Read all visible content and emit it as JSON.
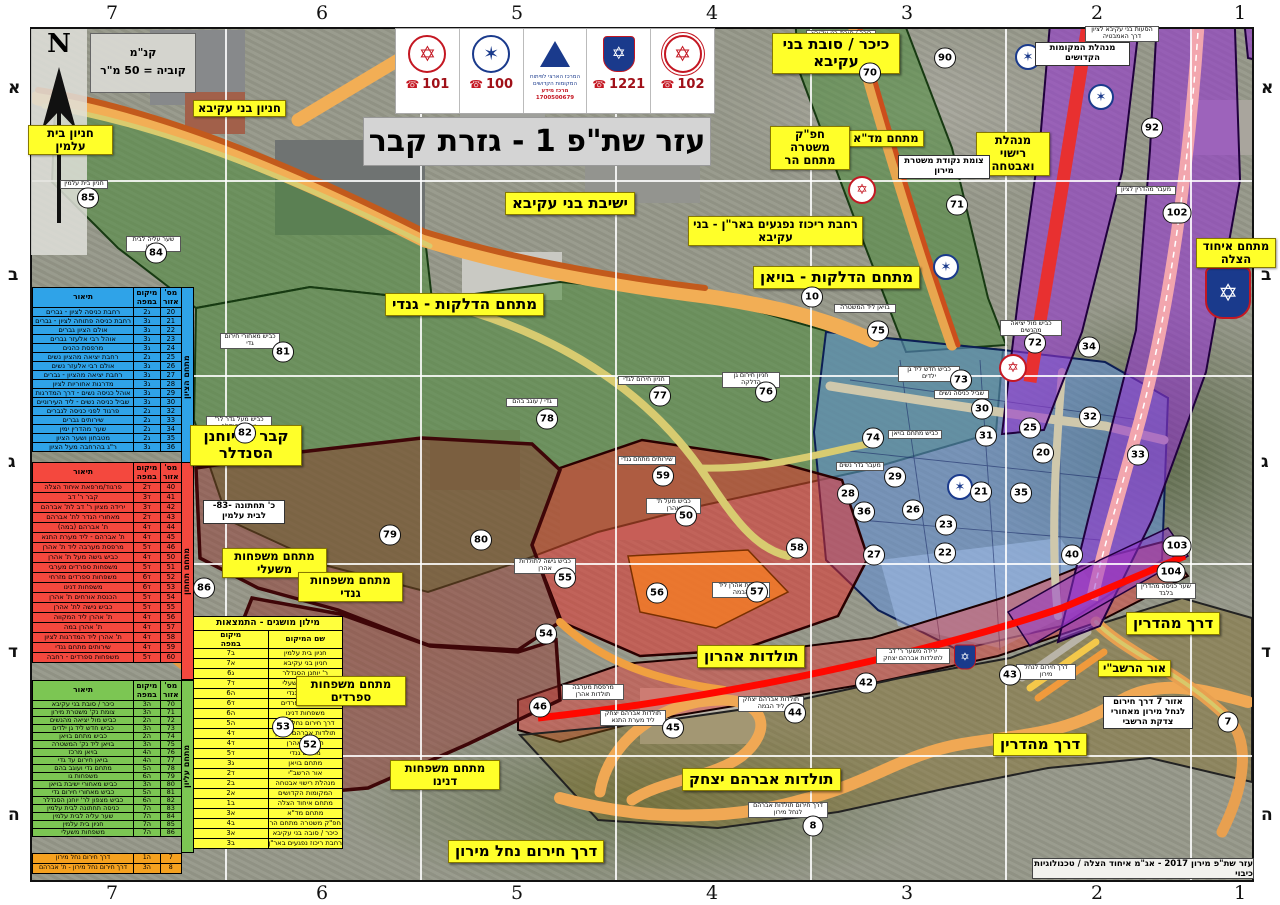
{
  "title": "עזר שת\"פ 1 - גזרת קבר",
  "attribution": "עזר שת\"פ מירון 2017 - אג\"מ איחוד הצלה / טכנולוגיות כיבוי",
  "north_label": "N",
  "scale": {
    "line1": "קנ\"מ",
    "line2": "קוביה = 50 מ\"ר"
  },
  "header": {
    "mda": {
      "phone": "101"
    },
    "police": {
      "phone": "100"
    },
    "center": {
      "line1": "המרכז הארצי לפיתוח",
      "line2": "המקומות הקדושים",
      "line3": "מרכז מידע",
      "line4": "1700500679"
    },
    "hatzalah": {
      "phone": "1221"
    },
    "fire": {
      "phone": "102"
    }
  },
  "grid": {
    "cols": [
      {
        "t": "7",
        "x": 112
      },
      {
        "t": "6",
        "x": 322
      },
      {
        "t": "5",
        "x": 517
      },
      {
        "t": "4",
        "x": 712
      },
      {
        "t": "3",
        "x": 907
      },
      {
        "t": "2",
        "x": 1097
      },
      {
        "t": "1",
        "x": 1240
      }
    ],
    "rows": [
      {
        "t": "א",
        "y": 88
      },
      {
        "t": "ב",
        "y": 275
      },
      {
        "t": "ג",
        "y": 462
      },
      {
        "t": "ד",
        "y": 652
      },
      {
        "t": "ה",
        "y": 815
      }
    ]
  },
  "legend": {
    "headers": {
      "n": "מס'\nאזור",
      "loc": "מיקום\nבמפה",
      "desc": "תיאור"
    },
    "blue": {
      "side": "מתחם הציון",
      "rows": [
        {
          "n": "20",
          "loc": "ג2",
          "d": "רחבת כניסה לציון - גברים"
        },
        {
          "n": "21",
          "loc": "ג3",
          "d": "רחבת כניסה פתוחה לציון - גברים"
        },
        {
          "n": "22",
          "loc": "ג3",
          "d": "אולם הציון גברים"
        },
        {
          "n": "23",
          "loc": "ג3",
          "d": "אוהל רבי אלעזר גברים"
        },
        {
          "n": "24",
          "loc": "ג3",
          "d": "מרפסת כהנים"
        },
        {
          "n": "25",
          "loc": "ג2",
          "d": "רחבת יציאה מהציון נשים"
        },
        {
          "n": "26",
          "loc": "ג3",
          "d": "אולם רבי אלעזר נשים"
        },
        {
          "n": "27",
          "loc": "ג3",
          "d": "רחבת יציאה מהציון - גברים"
        },
        {
          "n": "28",
          "loc": "ג3",
          "d": "מדרגות אחוריות לציון"
        },
        {
          "n": "29",
          "loc": "ג3",
          "d": "אוהל כניסה נשים - דרך המדרגות"
        },
        {
          "n": "30",
          "loc": "ג3",
          "d": "שביל כניסה נשים - ליד העירוניים"
        },
        {
          "n": "32",
          "loc": "ג2",
          "d": "פרגוד לפני כניסה לגברים"
        },
        {
          "n": "33",
          "loc": "ג2",
          "d": "שירותים גברים"
        },
        {
          "n": "34",
          "loc": "ג2",
          "d": "שער מהדרין ימין"
        },
        {
          "n": "35",
          "loc": "ג2",
          "d": "מטבחון ושער הציון"
        },
        {
          "n": "36",
          "loc": "ג3",
          "d": "ר\"ג בהרחבה מעל הציון"
        }
      ]
    },
    "red": {
      "side": "מתחם תחתון",
      "rows": [
        {
          "n": "40",
          "loc": "ד2",
          "d": "פרגוד/מרפאת איחוד הצלה"
        },
        {
          "n": "41",
          "loc": "ד3",
          "d": "קבר ר' דב"
        },
        {
          "n": "42",
          "loc": "ד3",
          "d": "ירידה מציון ר' דב לת' אברהם"
        },
        {
          "n": "43",
          "loc": "ד2",
          "d": "מאחורי הגדר לת' אברהם"
        },
        {
          "n": "44",
          "loc": "ד4",
          "d": "ת' אברהם (במה)"
        },
        {
          "n": "45",
          "loc": "ד4",
          "d": "ת' אברהם - ליד מערת התנא"
        },
        {
          "n": "46",
          "loc": "ד5",
          "d": "מרפסת מערבה ליד ת' אהרן"
        },
        {
          "n": "50",
          "loc": "ד4",
          "d": "כביש גישה מעל ת' אהרן"
        },
        {
          "n": "51",
          "loc": "ד5",
          "d": "משפחות ספרדים מערבי"
        },
        {
          "n": "52",
          "loc": "ד6",
          "d": "משפחות ספרדים מזרחי"
        },
        {
          "n": "53",
          "loc": "ד6",
          "d": "משפחות דנינו"
        },
        {
          "n": "54",
          "loc": "ד5",
          "d": "הכנסת אורחים ת' אהרן"
        },
        {
          "n": "55",
          "loc": "ד5",
          "d": "כביש גישה לת' אהרן"
        },
        {
          "n": "56",
          "loc": "ד4",
          "d": "ת' אהרן ליד המקווה"
        },
        {
          "n": "57",
          "loc": "ד4",
          "d": "ת' אהרן במה"
        },
        {
          "n": "58",
          "loc": "ד4",
          "d": "ת' אהרן ליד המדרגות לציון"
        },
        {
          "n": "59",
          "loc": "ד4",
          "d": "שירותים מתחם גנדי"
        },
        {
          "n": "60",
          "loc": "ד5",
          "d": "משפחות ספרדים - רחבה"
        }
      ]
    },
    "green": {
      "side": "מתחם עליון",
      "rows": [
        {
          "n": "70",
          "loc": "ה3",
          "d": "כיכר / סובת בני עקיבא"
        },
        {
          "n": "71",
          "loc": "ה3",
          "d": "צומת נק' משטרת מירון"
        },
        {
          "n": "72",
          "loc": "ה2",
          "d": "כביש מול יציאה מהנשים"
        },
        {
          "n": "73",
          "loc": "ה3",
          "d": "כביש חדש ליד גן ילדים"
        },
        {
          "n": "74",
          "loc": "ה2",
          "d": "כביש מתחם בויאן"
        },
        {
          "n": "75",
          "loc": "ה3",
          "d": "בויאן ליד נק' המשטרה"
        },
        {
          "n": "76",
          "loc": "ה4",
          "d": "בויאן מרכז"
        },
        {
          "n": "77",
          "loc": "ה4",
          "d": "בויאן חירום עד גדי"
        },
        {
          "n": "78",
          "loc": "ה5",
          "d": "מתחם גדי ועוגב בהם"
        },
        {
          "n": "79",
          "loc": "ה6",
          "d": "משפחות גו"
        },
        {
          "n": "80",
          "loc": "ה3",
          "d": "כביש מאחורי ישיבת בויאן"
        },
        {
          "n": "81",
          "loc": "ה5",
          "d": "כביש מאחורי חירום גדי"
        },
        {
          "n": "82",
          "loc": "ה6",
          "d": "כביש מצפון לר' יוחנן הסנדלר"
        },
        {
          "n": "83",
          "loc": "ה7",
          "d": "כניסה תחתונה לבית עלמין"
        },
        {
          "n": "84",
          "loc": "ה7",
          "d": "שער עליה לבית עלמין"
        },
        {
          "n": "85",
          "loc": "ה7",
          "d": "חניון בית עלמין"
        },
        {
          "n": "86",
          "loc": "ה7",
          "d": "משפחות משעלי"
        }
      ]
    },
    "orange": {
      "rows": [
        {
          "n": "7",
          "loc": "ה1",
          "d": "דרך חירום נחל מירון"
        },
        {
          "n": "8",
          "loc": "ה3",
          "d": "דרך חירום נחל מירון - ת' אברהם"
        }
      ]
    }
  },
  "glossary": {
    "title": "מילון מושגים - התמצאות",
    "headers": {
      "name": "שם המיקום",
      "loc": "מיקום\nבמפה"
    },
    "rows": [
      {
        "name": "חניון בית עלמין",
        "loc": "ב7"
      },
      {
        "name": "חניון בני עקיבא",
        "loc": "א7"
      },
      {
        "name": "ר' יוחנן הסנדלר",
        "loc": "ג6"
      },
      {
        "name": "משפחות משעלי",
        "loc": "ד7"
      },
      {
        "name": "משפחות גנדי",
        "loc": "ה6"
      },
      {
        "name": "משפחות ספרדים",
        "loc": "ד6"
      },
      {
        "name": "משפחות דנינו",
        "loc": "ה6"
      },
      {
        "name": "דרך חירום נחל מירון",
        "loc": "ה5"
      },
      {
        "name": "תולדות אברהם יצחק",
        "loc": "ד4"
      },
      {
        "name": "תולדות אהרן",
        "loc": "ד4"
      },
      {
        "name": "מתחם גנדי",
        "loc": "ד5"
      },
      {
        "name": "מתחם בויאן",
        "loc": "ג3"
      },
      {
        "name": "אור הרשב\"י",
        "loc": "ד2"
      },
      {
        "name": "מנהלת רישוי אבטחה",
        "loc": "ב2"
      },
      {
        "name": "המקומות הקדושים",
        "loc": "א2"
      },
      {
        "name": "מתחם איחוד הצלה",
        "loc": "ב1"
      },
      {
        "name": "מתחם מד\"א",
        "loc": "א3"
      },
      {
        "name": "חפ\"ק משטרה מתחם הר",
        "loc": "ב4"
      },
      {
        "name": "כיכר / סובה בני עקיבא",
        "loc": "א3"
      },
      {
        "name": "רחבת ריכוז נפגעים באר\"ן - בני עקיבא",
        "loc": "ב3"
      }
    ]
  },
  "callouts": [
    {
      "t": "ישיבת בני עקיבא",
      "x": 505,
      "y": 192,
      "cls": "ylg"
    },
    {
      "t": "מתחם הדלקות - בויאן",
      "x": 753,
      "y": 266,
      "cls": "ylg"
    },
    {
      "t": "מתחם הדלקות - גנדי",
      "x": 385,
      "y": 293,
      "cls": "ylg"
    },
    {
      "t": "תולדות אהרון",
      "x": 697,
      "y": 645,
      "cls": "ylg"
    },
    {
      "t": "תולדות אברהם יצחק",
      "x": 682,
      "y": 768,
      "cls": "ylg"
    },
    {
      "t": "דרך מהדרין",
      "x": 1126,
      "y": 612,
      "cls": "ylg"
    },
    {
      "t": "דרך מהדרין",
      "x": 993,
      "y": 733,
      "cls": "ylg"
    },
    {
      "t": "דרך חירום נחל מירון",
      "x": 448,
      "y": 840,
      "cls": "ylg"
    },
    {
      "t": "כיכר / סובת בני עקיבא",
      "x": 772,
      "y": 33,
      "cls": "ylg",
      "w": 128
    },
    {
      "t": "קבר ר' יוחנן הסנדלר",
      "x": 190,
      "y": 425,
      "cls": "ylg",
      "w": 112
    },
    {
      "t": "חניון בני עקיבא",
      "x": 193,
      "y": 100,
      "cls": "ymd"
    },
    {
      "t": "חניון בית עלמין",
      "x": 28,
      "y": 125,
      "cls": "ymd",
      "w": 85
    },
    {
      "t": "מתחם משפחות משעלי",
      "x": 222,
      "y": 548,
      "cls": "ymd",
      "w": 105
    },
    {
      "t": "מתחם משפחות גנדי",
      "x": 298,
      "y": 572,
      "cls": "ymd",
      "w": 105
    },
    {
      "t": "מתחם משפחות ספרדים",
      "x": 296,
      "y": 676,
      "cls": "ymd",
      "w": 110
    },
    {
      "t": "מתחם משפחות דנינו",
      "x": 390,
      "y": 760,
      "cls": "ymd",
      "w": 110
    },
    {
      "t": "מתחם איחוד הצלה",
      "x": 1196,
      "y": 238,
      "cls": "ymd",
      "w": 80
    },
    {
      "t": "אור הרשב\"י",
      "x": 1098,
      "y": 660,
      "cls": "ymd"
    },
    {
      "t": "מנהלת רישוי ואבטחה",
      "x": 976,
      "y": 132,
      "cls": "ymd",
      "w": 74
    },
    {
      "t": "מתחם מד\"א",
      "x": 848,
      "y": 130,
      "cls": "ymd"
    },
    {
      "t": "חפ\"ק משטרה מתחם הר",
      "x": 770,
      "y": 126,
      "cls": "ymd",
      "w": 80
    },
    {
      "t": "רחבת ריכוז נפגעים באר\"ן - בני עקיבא",
      "x": 688,
      "y": 216,
      "cls": "ymd",
      "w": 175
    },
    {
      "t": "צומת נקודת משטרת מירון",
      "x": 898,
      "y": 155,
      "cls": "wsm",
      "w": 92
    },
    {
      "t": "מנהלת המקומות הקדושים",
      "x": 1035,
      "y": 42,
      "cls": "wsm",
      "w": 95
    },
    {
      "t": "כ' תחתונה -83- לבית עלמין",
      "x": 203,
      "y": 500,
      "cls": "wsm",
      "w": 82
    },
    {
      "t": "אזור 7 דרך חירום לנחל מירון מאחורי צדקת הרשבי",
      "x": 1103,
      "y": 696,
      "cls": "wsm",
      "w": 90
    },
    {
      "t": "כיכר / סובת בני עקיבא",
      "x": 806,
      "y": 30,
      "cls": "wxs",
      "w": 70
    },
    {
      "t": "הסעות בני עקיבא לציון דרך האמבטיה",
      "x": 1085,
      "y": 26,
      "cls": "wxs",
      "w": 74
    },
    {
      "t": "מעבר מהדרין לציון",
      "x": 1116,
      "y": 186,
      "cls": "wxs",
      "w": 60
    },
    {
      "t": "בויאן ליד המשטרה",
      "x": 834,
      "y": 304,
      "cls": "wxs",
      "w": 62
    },
    {
      "t": "כביש מול יציאה מהנשים",
      "x": 1000,
      "y": 320,
      "cls": "wxs",
      "w": 62
    },
    {
      "t": "כביש חדש ליד גן ילדים",
      "x": 898,
      "y": 366,
      "cls": "wxs",
      "w": 62
    },
    {
      "t": "שביל כניסה נשים",
      "x": 934,
      "y": 390,
      "cls": "wxs",
      "w": 55
    },
    {
      "t": "כביש מתחם בויאן",
      "x": 888,
      "y": 430,
      "cls": "wxs",
      "w": 54
    },
    {
      "t": "מעבר גדר נשים",
      "x": 836,
      "y": 462,
      "cls": "wxs",
      "w": 48
    },
    {
      "t": "חניון חירום גן הדלקה",
      "x": 722,
      "y": 372,
      "cls": "wxs",
      "w": 58
    },
    {
      "t": "חניון חירום לגדי",
      "x": 618,
      "y": 376,
      "cls": "wxs",
      "w": 52
    },
    {
      "t": "גדי / עוגב בהם",
      "x": 506,
      "y": 398,
      "cls": "wxs",
      "w": 52
    },
    {
      "t": "שירותים מתחם גנדי",
      "x": 618,
      "y": 456,
      "cls": "wxs",
      "w": 58
    },
    {
      "t": "כביש מעל ת' אהרן",
      "x": 646,
      "y": 498,
      "cls": "wxs",
      "w": 55
    },
    {
      "t": "כביש גישה לתולדות אהרן",
      "x": 514,
      "y": 558,
      "cls": "wxs",
      "w": 62
    },
    {
      "t": "תולדות אהרן ליד הבמה",
      "x": 712,
      "y": 582,
      "cls": "wxs",
      "w": 58
    },
    {
      "t": "ירידה משער ר' דב לתולדות אברהם יצחק",
      "x": 876,
      "y": 648,
      "cls": "wxs",
      "w": 74
    },
    {
      "t": "תולדות אברהם יצחק ליד הבמה",
      "x": 738,
      "y": 696,
      "cls": "wxs",
      "w": 66
    },
    {
      "t": "תולדות אברהם יצחק ליד מערת התנא",
      "x": 600,
      "y": 710,
      "cls": "wxs",
      "w": 66
    },
    {
      "t": "דרך חירום תולדות אברהם לנחל מירון",
      "x": 748,
      "y": 802,
      "cls": "wxs",
      "w": 80
    },
    {
      "t": "כביש מעל גדר לר' יוחנן הסנדלר",
      "x": 206,
      "y": 416,
      "cls": "wxs",
      "w": 66
    },
    {
      "t": "חניון בית עלמין",
      "x": 60,
      "y": 180,
      "cls": "wxs",
      "w": 48
    },
    {
      "t": "שער עליה לבית עלמין",
      "x": 126,
      "y": 236,
      "cls": "wxs",
      "w": 55
    },
    {
      "t": "כביש מאחורי חירום גדי",
      "x": 220,
      "y": 333,
      "cls": "wxs",
      "w": 60
    },
    {
      "t": "מרפסת מערבה תולדות אהרן",
      "x": 562,
      "y": 684,
      "cls": "wxs",
      "w": 62
    },
    {
      "t": "שער כניסה מהדרין בלבד",
      "x": 1136,
      "y": 583,
      "cls": "wxs",
      "w": 60
    },
    {
      "t": "דרך חירום לנחל מירון",
      "x": 1016,
      "y": 664,
      "cls": "wxs",
      "w": 60
    }
  ],
  "markers": [
    {
      "n": "90",
      "x": 945,
      "y": 58
    },
    {
      "n": "70",
      "x": 870,
      "y": 73
    },
    {
      "n": "92",
      "x": 1152,
      "y": 128
    },
    {
      "n": "102",
      "x": 1177,
      "y": 213
    },
    {
      "n": "85",
      "x": 88,
      "y": 198
    },
    {
      "n": "84",
      "x": 156,
      "y": 253
    },
    {
      "n": "71",
      "x": 957,
      "y": 205
    },
    {
      "n": "10",
      "x": 812,
      "y": 297
    },
    {
      "n": "75",
      "x": 878,
      "y": 331
    },
    {
      "n": "81",
      "x": 283,
      "y": 352
    },
    {
      "n": "72",
      "x": 1035,
      "y": 343
    },
    {
      "n": "34",
      "x": 1089,
      "y": 347
    },
    {
      "n": "73",
      "x": 961,
      "y": 380
    },
    {
      "n": "77",
      "x": 660,
      "y": 396
    },
    {
      "n": "76",
      "x": 766,
      "y": 392
    },
    {
      "n": "30",
      "x": 982,
      "y": 409
    },
    {
      "n": "78",
      "x": 547,
      "y": 419
    },
    {
      "n": "25",
      "x": 1030,
      "y": 428
    },
    {
      "n": "74",
      "x": 873,
      "y": 438
    },
    {
      "n": "31",
      "x": 986,
      "y": 436
    },
    {
      "n": "32",
      "x": 1090,
      "y": 417
    },
    {
      "n": "20",
      "x": 1043,
      "y": 453
    },
    {
      "n": "33",
      "x": 1138,
      "y": 455
    },
    {
      "n": "82",
      "x": 245,
      "y": 433
    },
    {
      "n": "29",
      "x": 895,
      "y": 477
    },
    {
      "n": "59",
      "x": 663,
      "y": 476
    },
    {
      "n": "21",
      "x": 981,
      "y": 492
    },
    {
      "n": "35",
      "x": 1021,
      "y": 493
    },
    {
      "n": "28",
      "x": 848,
      "y": 494
    },
    {
      "n": "36",
      "x": 864,
      "y": 512
    },
    {
      "n": "26",
      "x": 913,
      "y": 510
    },
    {
      "n": "23",
      "x": 946,
      "y": 525
    },
    {
      "n": "79",
      "x": 390,
      "y": 535
    },
    {
      "n": "80",
      "x": 481,
      "y": 540
    },
    {
      "n": "50",
      "x": 686,
      "y": 516
    },
    {
      "n": "103",
      "x": 1177,
      "y": 546
    },
    {
      "n": "104",
      "x": 1171,
      "y": 572
    },
    {
      "n": "58",
      "x": 797,
      "y": 548
    },
    {
      "n": "22",
      "x": 945,
      "y": 553
    },
    {
      "n": "27",
      "x": 874,
      "y": 555
    },
    {
      "n": "40",
      "x": 1072,
      "y": 555
    },
    {
      "n": "86",
      "x": 204,
      "y": 588
    },
    {
      "n": "55",
      "x": 565,
      "y": 578
    },
    {
      "n": "56",
      "x": 657,
      "y": 593
    },
    {
      "n": "57",
      "x": 757,
      "y": 592
    },
    {
      "n": "54",
      "x": 546,
      "y": 634
    },
    {
      "n": "43",
      "x": 1010,
      "y": 675
    },
    {
      "n": "42",
      "x": 866,
      "y": 683
    },
    {
      "n": "46",
      "x": 540,
      "y": 707
    },
    {
      "n": "44",
      "x": 795,
      "y": 713
    },
    {
      "n": "45",
      "x": 673,
      "y": 728
    },
    {
      "n": "53",
      "x": 283,
      "y": 727
    },
    {
      "n": "52",
      "x": 310,
      "y": 745
    },
    {
      "n": "7",
      "x": 1228,
      "y": 722
    },
    {
      "n": "8",
      "x": 813,
      "y": 826
    }
  ],
  "emblems": [
    {
      "cls": "em-police",
      "x": 946,
      "y": 267
    },
    {
      "cls": "em-police",
      "x": 1028,
      "y": 57
    },
    {
      "cls": "em-police",
      "x": 1101,
      "y": 97
    },
    {
      "cls": "em-police",
      "x": 960,
      "y": 487
    },
    {
      "cls": "em-mda",
      "x": 862,
      "y": 190
    },
    {
      "cls": "em-mda",
      "x": 1013,
      "y": 368
    },
    {
      "cls": "em-uh",
      "x": 1228,
      "y": 293
    },
    {
      "cls": "em-uh-sm",
      "x": 965,
      "y": 657
    }
  ]
}
